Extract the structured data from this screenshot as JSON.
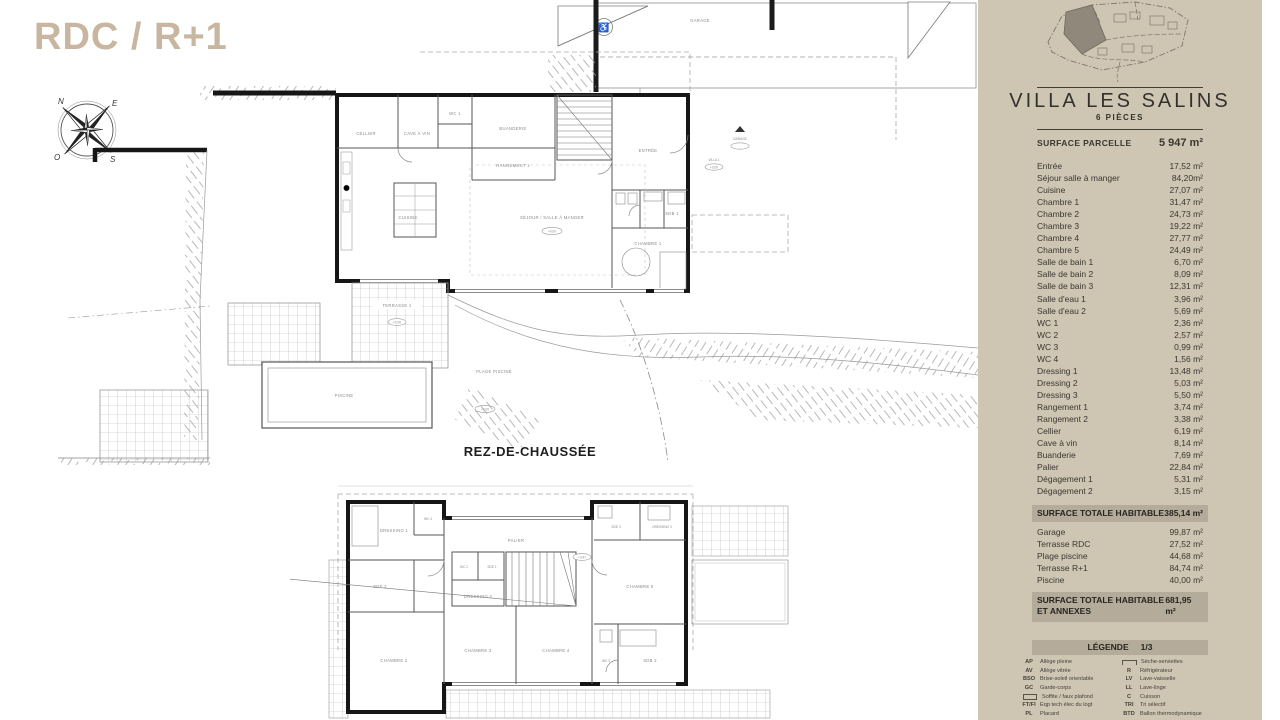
{
  "page": {
    "title": "RDC / R+1",
    "accent_color": "#c8b6a0",
    "sidebar_bg": "#cfc5b3",
    "bar_bg": "#b4ab9a"
  },
  "compass": {
    "n": "N",
    "e": "E",
    "s": "S",
    "o": "O"
  },
  "plans": {
    "rdc": {
      "caption": "REZ-DE-CHAUSSÉE",
      "labels": {
        "garage": "GARAGE",
        "cellier": "CELLIER",
        "cave": "CAVE À VIN",
        "wc1": "WC 1",
        "buanderie": "BUANDERIE",
        "rangement1": "RANGEMENT 1",
        "cuisine": "CUISINE",
        "sejour": "SÉJOUR / SALLE À MANGER",
        "entree": "ENTRÉE",
        "sdb1": "SDB 1",
        "chambre1": "CHAMBRE 1",
        "terrasse1": "TERRASSE 1",
        "plage": "PLAGE PISCINE",
        "piscine": "PISCINE",
        "villa1": "VILLA 1",
        "garage_marker": "GARAGE",
        "lvl0": "+0,00",
        "lvl2": "+2,00"
      }
    },
    "r1": {
      "labels": {
        "dressing1": "DRESSING 1",
        "sde2": "SDE 2",
        "wc4": "WC 4",
        "chambre2": "CHAMBRE 2",
        "palier": "PALIER",
        "wc2": "WC 2",
        "sde1": "SDE 1",
        "dressing2": "DRESSING 2",
        "chambre3": "CHAMBRE 3",
        "chambre4": "CHAMBRE 4",
        "sde3": "SDE 3",
        "dressing3": "DRESSING 3",
        "chambre5": "CHAMBRE 5",
        "sdb3": "SDB 3",
        "wc3": "WC 3",
        "lvl347": "+3,47"
      }
    }
  },
  "sidebar": {
    "title": "VILLA LES SALINS",
    "subtitle": "6 PIÈCES",
    "parcel": {
      "label": "SURFACE PARCELLE",
      "value": "5 947 m²"
    },
    "rooms": [
      {
        "label": "Entrée",
        "value": "17,52 m²"
      },
      {
        "label": "Séjour salle à manger",
        "value": "84,20m²"
      },
      {
        "label": "Cuisine",
        "value": "27,07 m²"
      },
      {
        "label": "Chambre 1",
        "value": "31,47 m²"
      },
      {
        "label": "Chambre 2",
        "value": "24,73 m²"
      },
      {
        "label": "Chambre 3",
        "value": "19,22 m²"
      },
      {
        "label": "Chambre 4",
        "value": "27,77 m²"
      },
      {
        "label": "Chambre 5",
        "value": "24,49 m²"
      },
      {
        "label": "Salle de bain 1",
        "value": "6,70 m²"
      },
      {
        "label": "Salle de bain 2",
        "value": "8,09 m²"
      },
      {
        "label": "Salle de bain 3",
        "value": "12,31 m²"
      },
      {
        "label": "Salle d'eau 1",
        "value": "3,96 m²"
      },
      {
        "label": "Salle d'eau 2",
        "value": "5,69 m²"
      },
      {
        "label": "WC 1",
        "value": "2,36 m²"
      },
      {
        "label": "WC 2",
        "value": "2,57 m²"
      },
      {
        "label": "WC 3",
        "value": "0,99 m²"
      },
      {
        "label": "WC 4",
        "value": "1,56 m²"
      },
      {
        "label": "Dressing 1",
        "value": "13,48 m²"
      },
      {
        "label": "Dressing 2",
        "value": "5,03 m²"
      },
      {
        "label": "Dressing 3",
        "value": "5,50 m²"
      },
      {
        "label": "Rangement 1",
        "value": "3,74 m²"
      },
      {
        "label": "Rangement 2",
        "value": "3,38 m²"
      },
      {
        "label": "Cellier",
        "value": "6,19 m²"
      },
      {
        "label": "Cave à vin",
        "value": "8,14 m²"
      },
      {
        "label": "Buanderie",
        "value": "7,69 m²"
      },
      {
        "label": "Palier",
        "value": "22,84 m²"
      },
      {
        "label": "Dégagement 1",
        "value": "5,31 m²"
      },
      {
        "label": "Dégagement 2",
        "value": "3,15 m²"
      }
    ],
    "total_habitable": {
      "label": "SURFACE TOTALE HABITABLE",
      "value": "385,14 m²"
    },
    "annexes": [
      {
        "label": "Garage",
        "value": "99,87 m²"
      },
      {
        "label": "Terrasse RDC",
        "value": "27,52 m²"
      },
      {
        "label": "Plage piscine",
        "value": "44,68 m²"
      },
      {
        "label": "Terrasse R+1",
        "value": "84,74 m²"
      },
      {
        "label": "Piscine",
        "value": "40,00 m²"
      }
    ],
    "total_annexes": {
      "label": "SURFACE TOTALE HABITABLE ET ANNEXES",
      "value": "681,95 m²"
    },
    "legend": {
      "title": "LÉGENDE",
      "page": "1/3",
      "left": [
        {
          "abbr": "AP",
          "label": "Allège pleine"
        },
        {
          "abbr": "AV",
          "label": "Allège vitrée"
        },
        {
          "abbr": "BSO",
          "label": "Brise-soleil orientable"
        },
        {
          "abbr": "GC",
          "label": "Garde-corps"
        },
        {
          "abbr": "",
          "icon": "soffit-box-icon",
          "label": "Soffite / faux plafond"
        },
        {
          "abbr": "FT/FI",
          "label": "Eqp tech élec du logt"
        },
        {
          "abbr": "PL",
          "label": "Placard"
        }
      ],
      "right": [
        {
          "abbr": "",
          "icon": "towel-radiator-icon",
          "label": "Sèche-serviettes"
        },
        {
          "abbr": "R",
          "label": "Réfrigérateur"
        },
        {
          "abbr": "LV",
          "label": "Lave-vaisselle"
        },
        {
          "abbr": "LL",
          "label": "Lave-linge"
        },
        {
          "abbr": "C",
          "label": "Cuisson"
        },
        {
          "abbr": "TRI",
          "label": "Tri sélectif"
        },
        {
          "abbr": "BTD",
          "label": "Ballon thermodynamique"
        }
      ]
    }
  }
}
